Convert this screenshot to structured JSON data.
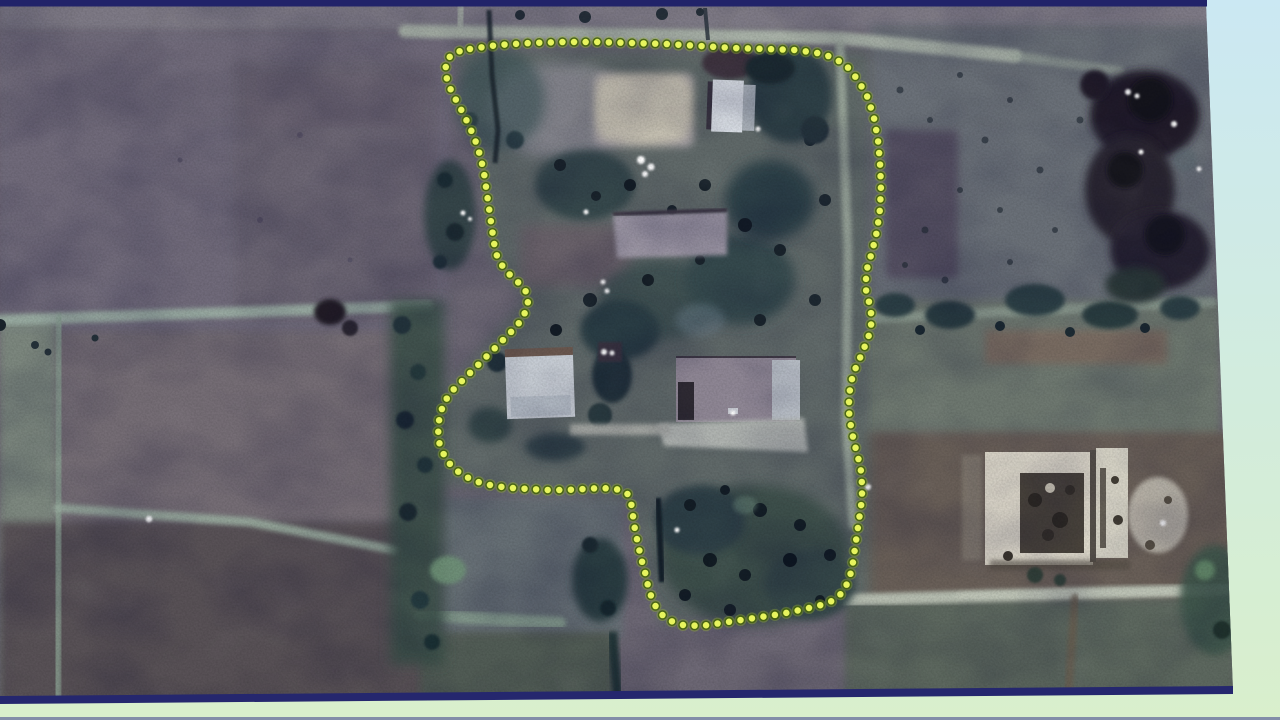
{
  "scene": {
    "type": "satellite-photo-on-slide",
    "description": "Photographed presentation slide showing an overhead satellite image of a rural village compound. Fields in muted purple-grey tones surround a central homestead with trees, a bright open courtyard, white-roofed buildings and a walled white compound at lower right. A yellow dotted annotation line encircles the central compound. The photo sits on a pale blue-to-green slide background with dark navy border strips at top and bottom.",
    "visible_text": "none"
  },
  "slide": {
    "background_top_color": "#cbe8f3",
    "background_mid_color": "#d2ecdd",
    "background_bottom_color": "#d9efcc",
    "border_navy_color": "#23246b"
  },
  "annotation": {
    "label": "compound-boundary-outline",
    "style": "dotted",
    "dot_color": "#e7f45e",
    "dot_halo_color": "#44600e",
    "dot_glow_color": "#9db832",
    "dot_diameter_px": 7,
    "dot_spacing_px": 11.6,
    "outline_points": [
      [
        470,
        49
      ],
      [
        498,
        45
      ],
      [
        530,
        43
      ],
      [
        564,
        42
      ],
      [
        598,
        42
      ],
      [
        632,
        43
      ],
      [
        666,
        44
      ],
      [
        700,
        46
      ],
      [
        734,
        48
      ],
      [
        766,
        49
      ],
      [
        796,
        50
      ],
      [
        824,
        54
      ],
      [
        845,
        64
      ],
      [
        858,
        80
      ],
      [
        868,
        98
      ],
      [
        874,
        118
      ],
      [
        878,
        140
      ],
      [
        880,
        163
      ],
      [
        881,
        186
      ],
      [
        880,
        209
      ],
      [
        877,
        231
      ],
      [
        872,
        252
      ],
      [
        866,
        272
      ],
      [
        866,
        290
      ],
      [
        870,
        306
      ],
      [
        872,
        320
      ],
      [
        869,
        335
      ],
      [
        863,
        351
      ],
      [
        856,
        367
      ],
      [
        851,
        382
      ],
      [
        849,
        397
      ],
      [
        849,
        412
      ],
      [
        851,
        427
      ],
      [
        854,
        442
      ],
      [
        858,
        457
      ],
      [
        861,
        471
      ],
      [
        862,
        485
      ],
      [
        862,
        499
      ],
      [
        860,
        513
      ],
      [
        858,
        527
      ],
      [
        856,
        541
      ],
      [
        854,
        555
      ],
      [
        852,
        569
      ],
      [
        848,
        582
      ],
      [
        842,
        593
      ],
      [
        832,
        601
      ],
      [
        818,
        606
      ],
      [
        800,
        610
      ],
      [
        781,
        614
      ],
      [
        761,
        617
      ],
      [
        741,
        620
      ],
      [
        721,
        623
      ],
      [
        701,
        626
      ],
      [
        683,
        625
      ],
      [
        668,
        620
      ],
      [
        658,
        611
      ],
      [
        652,
        599
      ],
      [
        648,
        586
      ],
      [
        645,
        572
      ],
      [
        641,
        558
      ],
      [
        638,
        544
      ],
      [
        635,
        530
      ],
      [
        633,
        516
      ],
      [
        631,
        502
      ],
      [
        627,
        493
      ],
      [
        616,
        489
      ],
      [
        601,
        488
      ],
      [
        584,
        489
      ],
      [
        566,
        490
      ],
      [
        548,
        490
      ],
      [
        530,
        489
      ],
      [
        512,
        488
      ],
      [
        494,
        486
      ],
      [
        478,
        482
      ],
      [
        464,
        476
      ],
      [
        452,
        467
      ],
      [
        444,
        455
      ],
      [
        439,
        442
      ],
      [
        438,
        428
      ],
      [
        440,
        414
      ],
      [
        445,
        401
      ],
      [
        453,
        390
      ],
      [
        463,
        380
      ],
      [
        474,
        369
      ],
      [
        485,
        358
      ],
      [
        496,
        347
      ],
      [
        507,
        336
      ],
      [
        517,
        326
      ],
      [
        524,
        315
      ],
      [
        528,
        304
      ],
      [
        527,
        293
      ],
      [
        520,
        284
      ],
      [
        511,
        276
      ],
      [
        503,
        267
      ],
      [
        497,
        256
      ],
      [
        494,
        243
      ],
      [
        492,
        229
      ],
      [
        490,
        215
      ],
      [
        488,
        201
      ],
      [
        486,
        187
      ],
      [
        484,
        173
      ],
      [
        481,
        159
      ],
      [
        477,
        145
      ],
      [
        471,
        130
      ],
      [
        464,
        115
      ],
      [
        456,
        100
      ],
      [
        449,
        86
      ],
      [
        445,
        72
      ],
      [
        447,
        59
      ],
      [
        456,
        52
      ]
    ]
  },
  "imagery": {
    "kind": "satellite-aerial",
    "palette": {
      "field_base": "#6c6774",
      "field_dark": "#585156",
      "field_green": "#5d685e",
      "boundary_band": "#9bafa4",
      "road_light": "#aeb7ab",
      "trees_dark": "#1f2d35",
      "trees_mid": "#324549",
      "courtyard_bright": "#c6c1b2",
      "building_white": "#d8dde4",
      "compound_wall_white": "#ddd8ca"
    },
    "features": [
      {
        "name": "open-courtyard",
        "location": "top centre inside outline"
      },
      {
        "name": "white-roof-building",
        "location": "top right inside outline"
      },
      {
        "name": "central-shed",
        "location": "middle of compound"
      },
      {
        "name": "west-house",
        "location": "mid-left inside outline"
      },
      {
        "name": "east-house-with-apron",
        "location": "mid-right inside outline"
      },
      {
        "name": "tree-grove",
        "location": "throughout compound and lower lobe"
      },
      {
        "name": "top-road",
        "location": "horizontal track along top of photo"
      },
      {
        "name": "interior-track",
        "location": "vertical track inside eastern edge of outline"
      },
      {
        "name": "bottom-road",
        "location": "horizontal road lower right"
      },
      {
        "name": "walled-white-compound",
        "location": "lower right of photo"
      },
      {
        "name": "field-boundaries",
        "location": "left half field grid"
      }
    ]
  }
}
